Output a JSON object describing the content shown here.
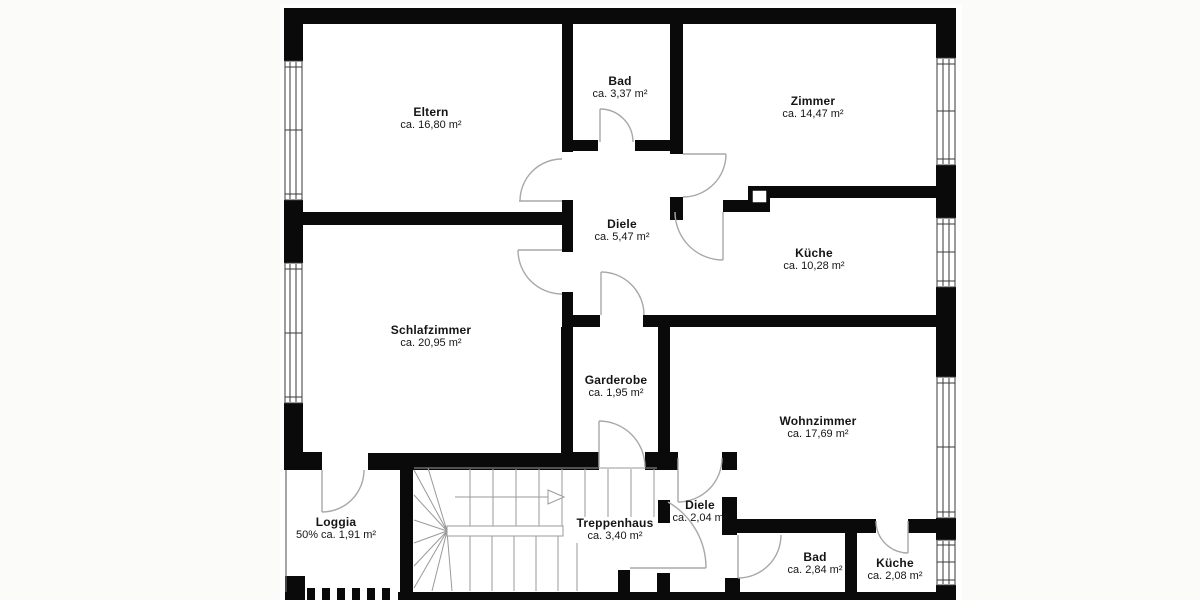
{
  "plan": {
    "title": "Wohnungsgrundriss",
    "colors": {
      "wall": "#0a0a0a",
      "door_line": "#a8a8a8",
      "stair_line": "#9a9a9a",
      "window_line": "#3a3a3a",
      "background": "#fbfbfa",
      "floor": "#ffffff"
    },
    "rooms": [
      {
        "id": "eltern",
        "name": "Eltern",
        "area": "ca. 16,80 m²"
      },
      {
        "id": "bad-og",
        "name": "Bad",
        "area": "ca. 3,37 m²"
      },
      {
        "id": "zimmer",
        "name": "Zimmer",
        "area": "ca. 14,47 m²"
      },
      {
        "id": "diele-og",
        "name": "Diele",
        "area": "ca. 5,47 m²"
      },
      {
        "id": "kueche-og",
        "name": "Küche",
        "area": "ca. 10,28 m²"
      },
      {
        "id": "schlafzimmer",
        "name": "Schlafzimmer",
        "area": "ca. 20,95 m²"
      },
      {
        "id": "garderobe",
        "name": "Garderobe",
        "area": "ca. 1,95 m²"
      },
      {
        "id": "wohnzimmer",
        "name": "Wohnzimmer",
        "area": "ca. 17,69 m²"
      },
      {
        "id": "loggia",
        "name": "Loggia",
        "area": "50% ca. 1,91 m²"
      },
      {
        "id": "treppenhaus",
        "name": "Treppenhaus",
        "area": "ca. 3,40 m²"
      },
      {
        "id": "diele-unten",
        "name": "Diele",
        "area": "ca. 2,04 m²"
      },
      {
        "id": "bad-unten",
        "name": "Bad",
        "area": "ca. 2,84 m²"
      },
      {
        "id": "kueche-unten",
        "name": "Küche",
        "area": "ca. 2,08 m²"
      }
    ]
  }
}
